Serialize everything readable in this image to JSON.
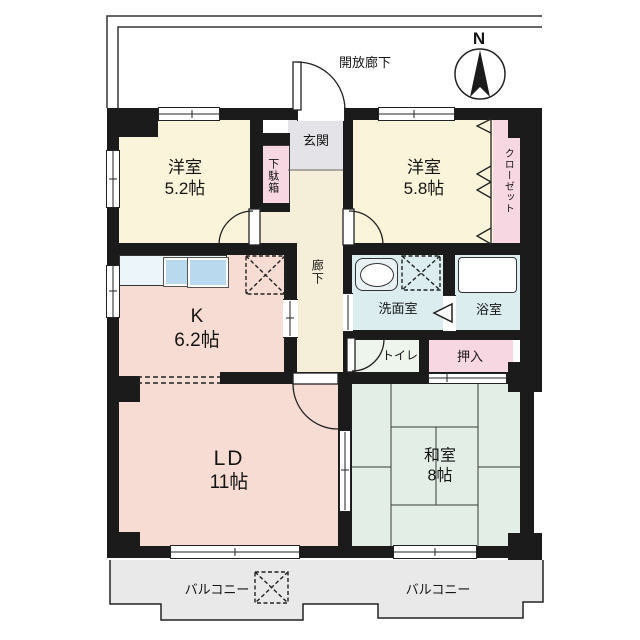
{
  "plan_title": "マンション間取り図",
  "compass": {
    "north": "N"
  },
  "labels": {
    "open_corridor": "開放廊下",
    "balcony_left": "バルコニー",
    "balcony_right": "バルコニー"
  },
  "rooms": {
    "western_5_2": {
      "name": "洋室",
      "size": "5.2帖"
    },
    "western_5_8": {
      "name": "洋室",
      "size": "5.8帖"
    },
    "kitchen": {
      "name": "K",
      "size": "6.2帖"
    },
    "living_dining": {
      "name": "LD",
      "size": "11帖"
    },
    "japanese_room": {
      "name": "和室",
      "size": "8帖"
    },
    "entrance": {
      "name": "玄関"
    },
    "shoe_cabinet": {
      "name": "下駄箱"
    },
    "closet": {
      "name": "クローゼット"
    },
    "hallway": {
      "name": "廊下"
    },
    "washroom": {
      "name": "洗面室"
    },
    "bathroom": {
      "name": "浴室"
    },
    "toilet": {
      "name": "トイレ"
    },
    "futon_closet": {
      "name": "押入"
    }
  },
  "colors": {
    "wall": "#1b1b1b",
    "western_room": "#faf5da",
    "hallway": "#f5efd9",
    "entrance": "#e4e4e8",
    "kitchen_living": "#f7dcd3",
    "japanese_room": "#e3eee6",
    "wet_area": "#dcedf0",
    "toilet": "#eef5ec",
    "storage_pink": "#f7d7e2",
    "balcony": "#e9e9e9",
    "counter_blue": "#b9d9ee"
  }
}
